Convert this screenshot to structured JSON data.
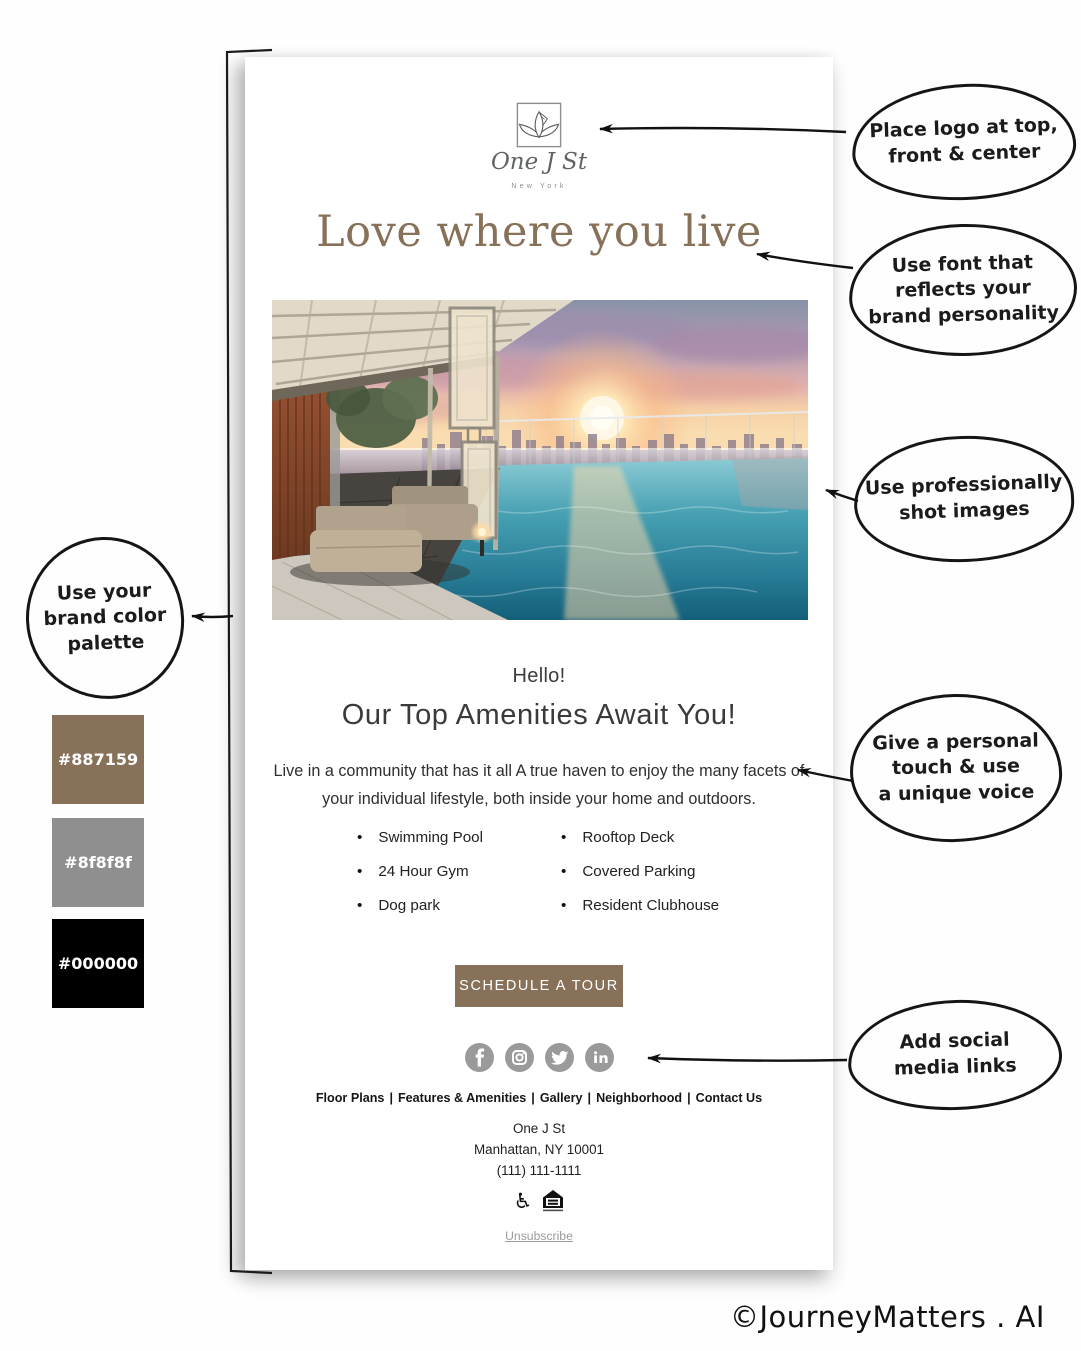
{
  "email": {
    "logo": {
      "name": "One J St",
      "tagline": "New York"
    },
    "headline": "Love where you live",
    "greeting": "Hello!",
    "heading": "Our Top Amenities Await You!",
    "body": {
      "line1": "Live in a community that has it all A true haven to enjoy the many facets of",
      "line2": "your individual lifestyle, both inside your home and outdoors."
    },
    "amenities": {
      "left": [
        "Swimming Pool",
        "24 Hour Gym",
        "Dog park"
      ],
      "right": [
        "Rooftop Deck",
        "Covered Parking",
        "Resident Clubhouse"
      ]
    },
    "cta_label": "SCHEDULE A TOUR",
    "social_icons": [
      "facebook",
      "instagram",
      "twitter",
      "linkedin"
    ],
    "footer_nav": {
      "separator": "|",
      "items": [
        "Floor Plans",
        "Features & Amenities",
        "Gallery",
        "Neighborhood",
        "Contact Us"
      ]
    },
    "address": {
      "line1": "One J St",
      "line2": "Manhattan, NY 10001",
      "line3": "(111) 111-1111"
    },
    "accessibility_icons": [
      "wheelchair",
      "equal-housing"
    ],
    "unsubscribe_label": "Unsubscribe"
  },
  "palette": [
    {
      "hex": "#887159"
    },
    {
      "hex": "#8f8f8f"
    },
    {
      "hex": "#000000"
    }
  ],
  "annotations": {
    "logo": {
      "lines": [
        "Place logo at top,",
        "front & center"
      ]
    },
    "font": {
      "lines": [
        "Use font that",
        "reflects your",
        "brand personality"
      ]
    },
    "images": {
      "lines": [
        "Use professionally",
        "shot images"
      ]
    },
    "palette": {
      "lines": [
        "Use your",
        "brand color",
        "palette"
      ]
    },
    "personal": {
      "lines": [
        "Give a personal",
        "touch & use",
        "a unique voice"
      ]
    },
    "social": {
      "lines": [
        "Add social",
        "media links"
      ]
    }
  },
  "colors": {
    "brand": "#887159",
    "gray": "#8f8f8f",
    "black": "#000000"
  },
  "watermark": "©JourneyMatters . AI"
}
